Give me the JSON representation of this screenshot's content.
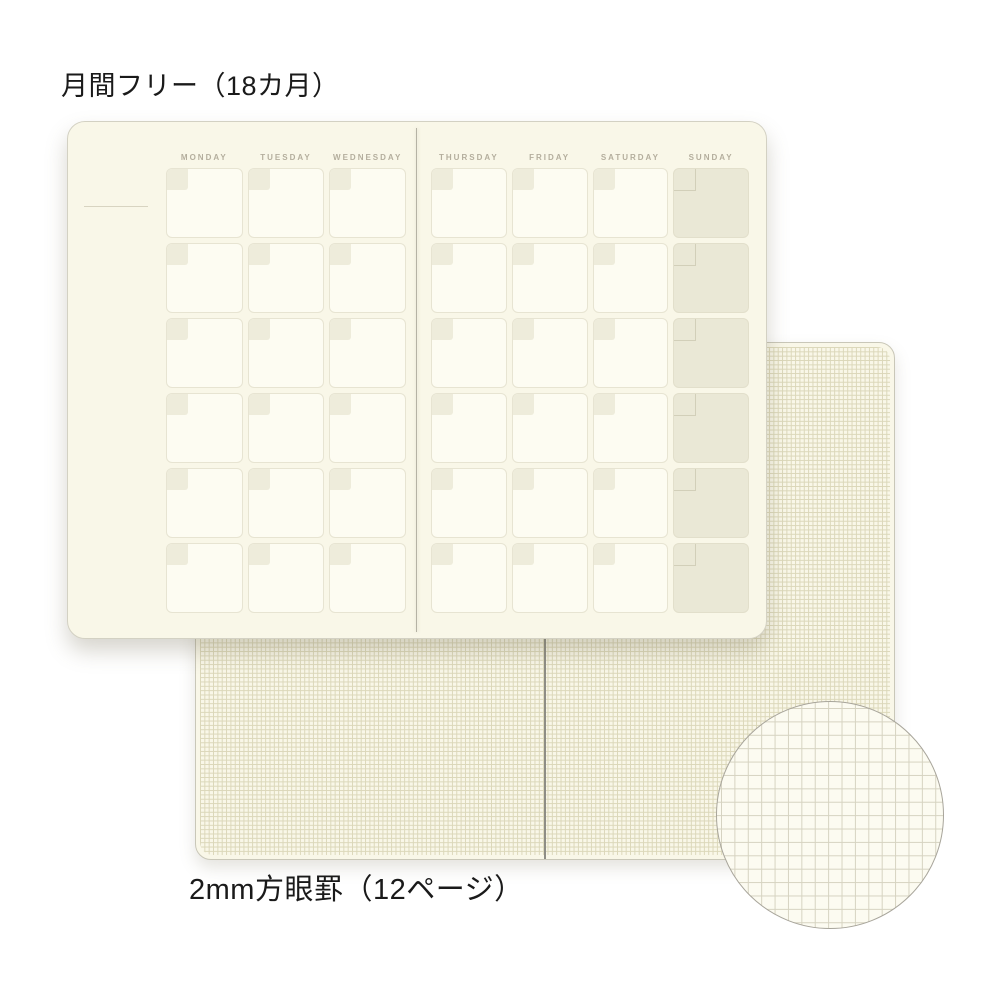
{
  "labels": {
    "top": "月間フリー（18カ月）",
    "bottom": "2mm方眼罫（12ページ）"
  },
  "calendar": {
    "left_page_days": [
      "MONDAY",
      "TUESDAY",
      "WEDNESDAY"
    ],
    "right_page_days": [
      "THURSDAY",
      "FRIDAY",
      "SATURDAY",
      "SUNDAY"
    ],
    "weeks_per_page": 6,
    "highlighted_day": "SUNDAY"
  },
  "grid_sheet": {
    "ruling": "2mm方眼罫",
    "pages": "12ページ"
  },
  "colors": {
    "bg": "#ffffff",
    "label-text": "#1a1a1a",
    "paper": "#f9f7e8",
    "paper-border": "#d3d1c3",
    "paper-border-light": "#c9c7b8",
    "cell-fill": "#fdfcf2",
    "cell-border": "#e7e4d2",
    "corner-square": "#eeecdb",
    "sunday-fill": "#eae8d6",
    "sunday-border": "#e2dfcb",
    "sunday-square-border": "#d2cfb9",
    "header-text": "#b4ae9d",
    "gutter-line": "#b5b2a4",
    "grid-gutter-line": "#8e8d85",
    "grid-line": "#dbd7b9",
    "magnifier-grid-line": "#d6d3c1",
    "magnifier-fill": "#fcfbf1",
    "magnifier-border": "#a8a59b",
    "month-line": "#d8d4c1"
  }
}
